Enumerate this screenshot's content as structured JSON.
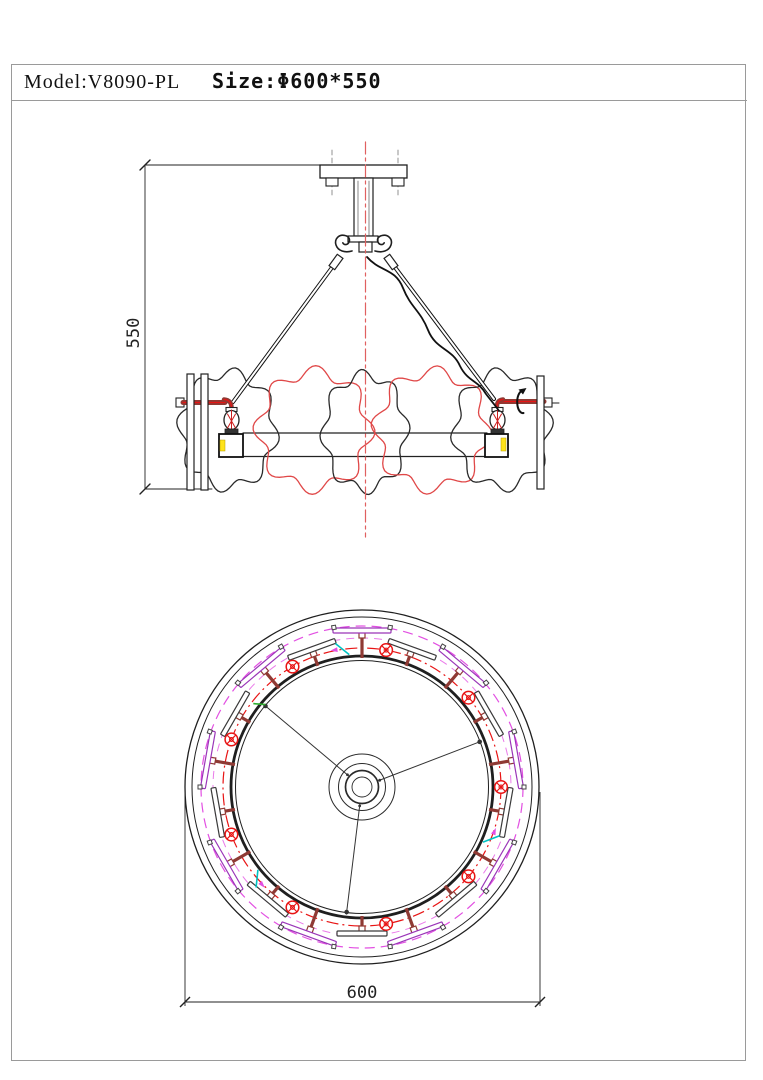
{
  "title_block": {
    "model_label": "Model:V8090-PL",
    "size_label": "Size:Φ600*550"
  },
  "colors": {
    "line": "#1f1f1f",
    "soft_line": "#555555",
    "red_shade": "#e04848",
    "centerline_red": "#e06060",
    "magenta": "#e24fe2",
    "magenta_light": "#ea7aea",
    "purple_slot": "#9a35b8",
    "dark_slot": "#3a3a3a",
    "maroon": "#8f3a34",
    "lamp_red": "#e81414",
    "cyan": "#00c2c2",
    "green": "#2fae2f",
    "yellow": "#ffe31a",
    "frame_gray": "#9a9a9a"
  },
  "elevation": {
    "dim_label": "550",
    "shades": [
      {
        "cx": 228,
        "cy": 430,
        "rx": 47,
        "ry": 57,
        "waves": 8,
        "amp": 0.1,
        "phase": 0.4,
        "color": "#2a2a2a"
      },
      {
        "cx": 314,
        "cy": 430,
        "rx": 55,
        "ry": 58,
        "waves": 8,
        "amp": 0.11,
        "phase": 1.3,
        "color": "#e04848"
      },
      {
        "cx": 365,
        "cy": 432,
        "rx": 41,
        "ry": 57,
        "waves": 8,
        "amp": 0.1,
        "phase": 2.2,
        "color": "#2a2a2a"
      },
      {
        "cx": 432,
        "cy": 430,
        "rx": 55,
        "ry": 58,
        "waves": 8,
        "amp": 0.11,
        "phase": 0.8,
        "color": "#e04848"
      },
      {
        "cx": 502,
        "cy": 430,
        "rx": 47,
        "ry": 57,
        "waves": 8,
        "amp": 0.1,
        "phase": 2.7,
        "color": "#2a2a2a"
      }
    ]
  },
  "plan": {
    "dim_label": "600",
    "center_x": 362,
    "center_y": 787,
    "rings": [
      {
        "r": 177,
        "stroke": "#1f1f1f",
        "width": 1.3
      },
      {
        "r": 170,
        "stroke": "#1f1f1f",
        "width": 1.0
      },
      {
        "r": 161,
        "stroke": "#e24fe2",
        "width": 1.2,
        "dash": "10 6"
      },
      {
        "r": 149,
        "stroke": "#ea7aea",
        "width": 1.0,
        "dash": "8 6"
      },
      {
        "r": 139,
        "stroke": "#e81414",
        "width": 1.2,
        "dash": "12 4 2 4"
      },
      {
        "r": 131,
        "stroke": "#1f1f1f",
        "width": 2.8
      },
      {
        "r": 126.5,
        "stroke": "#1f1f1f",
        "width": 1.0
      },
      {
        "r": 33,
        "stroke": "#2a2a2a",
        "width": 1.0
      },
      {
        "r": 23.5,
        "stroke": "#2a2a2a",
        "width": 1.0
      },
      {
        "r": 16.5,
        "stroke": "#2a2a2a",
        "width": 1.7
      },
      {
        "r": 10,
        "stroke": "#2a2a2a",
        "width": 0.9
      }
    ],
    "slot_count": 18,
    "slot_start_deg": 10,
    "slot_step_deg": 20,
    "lamp_count": 9,
    "lamp_start_deg": 0,
    "lamp_step_deg": 40,
    "lamp_radius": 139,
    "rod_angles_deg": [
      140,
      21,
      263
    ],
    "cyan_tick_angles_deg": [
      98,
      338,
      221
    ],
    "green_tick_angle_deg": 141
  }
}
